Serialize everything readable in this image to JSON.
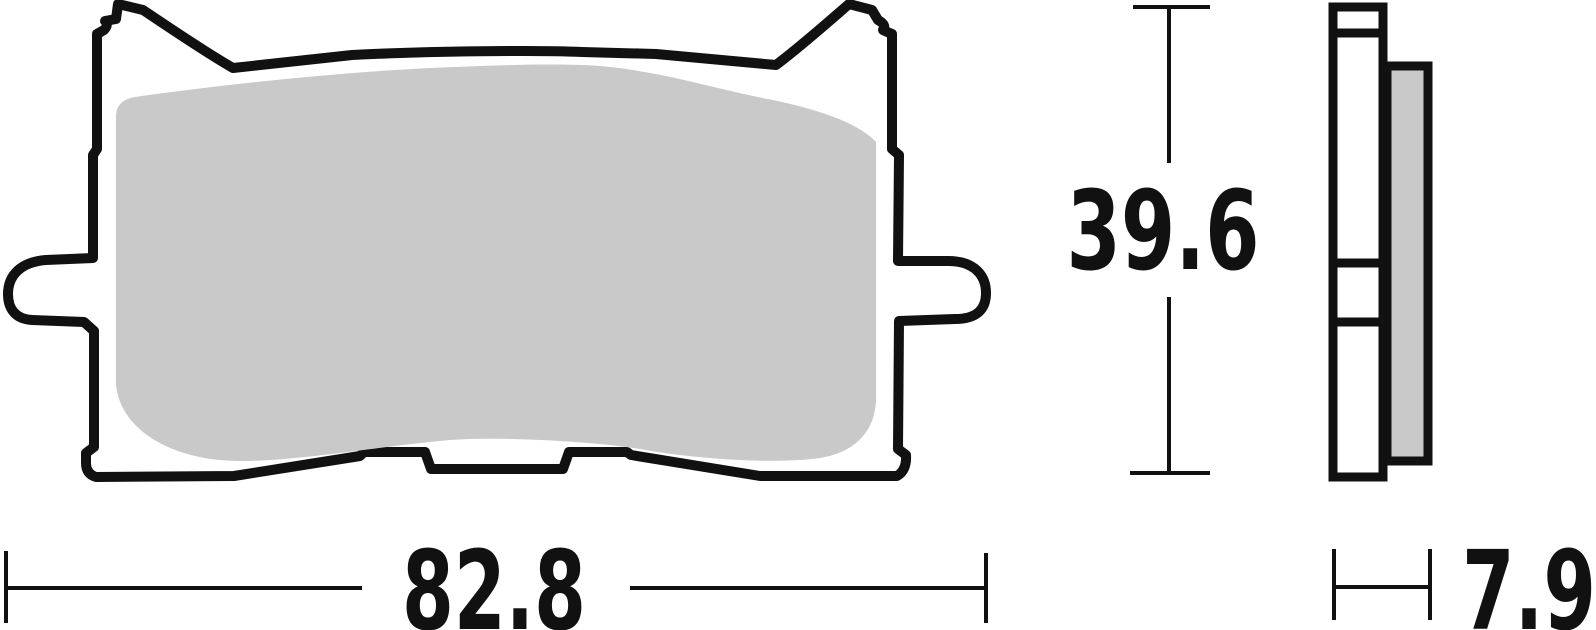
{
  "dimensions": {
    "width": "82.8",
    "height": "39.6",
    "thickness": "7.9"
  },
  "colors": {
    "line": "#111111",
    "friction_material": "#c9c9c9",
    "backing_plate_fill": "#ffffff",
    "background": "#ffffff"
  }
}
